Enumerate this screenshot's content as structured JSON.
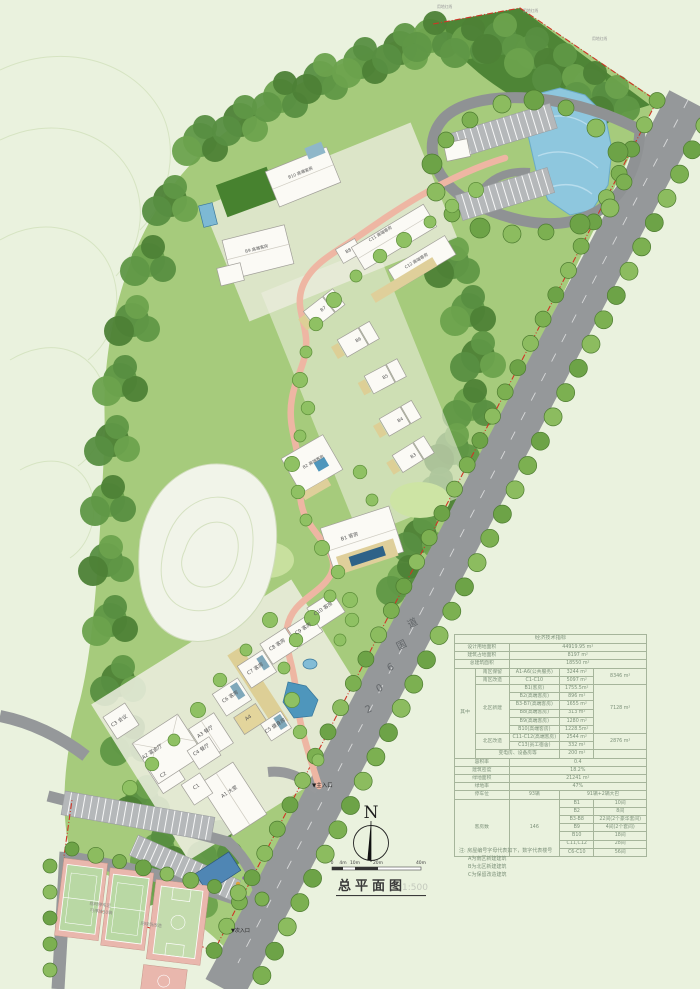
{
  "annot": {
    "north": "N",
    "title": "总平面图",
    "scale": "1:500",
    "bar": [
      "0",
      "4m",
      "10m",
      "20m",
      "40m"
    ]
  },
  "map": {
    "road": [
      "2",
      "0",
      "6",
      "国",
      "道"
    ],
    "entrance_main": "▼主入口",
    "entrance_secondary": "▼次入口",
    "boundary_label": "用地红线",
    "courts": {
      "parking_line1": "临时停车区",
      "parking_line2": "可停放50辆",
      "tennis_label": "网球场改造"
    },
    "buildings": {
      "a1": "A1 大堂",
      "a2": "A2 宴会厅",
      "a3": "A3 餐厅",
      "a4": "A4",
      "c1": "C1",
      "c2": "C2",
      "c3": "C3 会议",
      "c4": "C4 餐厅",
      "c5": "C5 健身房",
      "c6": "C6 客房",
      "c7": "C7 客房",
      "c8": "C8 客房",
      "c9": "C9 客房",
      "c10": "C10 客房",
      "b1": "B1 客房",
      "b2": "B2 高端客房",
      "b3": "B3",
      "b4": "B4",
      "b5": "B5",
      "b6": "B6",
      "b7": "B7",
      "b8": "B8",
      "b9": "B9 高端客房",
      "b10": "B10 高端客房",
      "c11": "C11 高端客房",
      "c12": "C12 高端客房"
    }
  },
  "ect": {
    "header": "经济技术指标",
    "r1l": "设计用地面积",
    "r1v": "44919.95 m²",
    "r2l": "建筑占地面积",
    "r2v": "8197  m²",
    "r3l": "总建筑面积",
    "r3v": "18550  m²",
    "among": "其中",
    "sk": "南区保留",
    "skn": "A1-A6(公共服务)",
    "skv": "3244 m²",
    "skt": "8346 m²",
    "sr": "南区改造",
    "srn": "C1-C10",
    "srv": "5097 m²",
    "nn": "北区新建",
    "nnt": "7128 m²",
    "nn1n": "B1(客房)",
    "nn1v": "1755.5m²",
    "nn2n": "B2(高端客房)",
    "nn2v": "896  m²",
    "nn3n": "B3-B7(高端客房)",
    "nn3v": "1655  m²",
    "nn4n": "B8(高端客房)",
    "nn4v": "313  m²",
    "nn5n": "B9(高端客房)",
    "nn5v": "1280  m²",
    "nn6n": "B10(高端客房)",
    "nn6v": "1228.5m²",
    "nr": "北区改造",
    "nrt": "2876 m²",
    "nr1n": "C11-C12(高端客房)",
    "nr1v": "2544 m²",
    "nr2n": "C13(员工宿舍)",
    "nr2v": "332  m²",
    "pw": "变电房、设备房等",
    "pwv": "200  m²",
    "far_l": "容积率",
    "far_v": "0.4",
    "den_l": "建筑密度",
    "den_v": "18.2%",
    "green_l": "绿地面积",
    "green_v": "21241    m²",
    "gr_l": "绿地率",
    "gr_v": "47%",
    "park_l": "停车位",
    "park_v": "93辆",
    "park_d": "91辆+2辆大巴",
    "room_l": "客房数",
    "room_v": "146",
    "rm1n": "B1",
    "rm1v": "10间",
    "rm2n": "B2",
    "rm2v": "8间",
    "rm3n": "B3-B8",
    "rm3v": "22间(2个豪华套间)",
    "rm4n": "B9",
    "rm4v": "4间(2个套间)",
    "rm5n": "B10",
    "rm5v": "18间",
    "rm6n": "C11,C12",
    "rm6v": "28间",
    "rm7n": "C6-C10",
    "rm7v": "56间",
    "note1": "注: 房屋编号字母代表如下，数字代表楼号",
    "note2": "A为南区新建建筑",
    "note3": "B为北区新建建筑",
    "note4": "C为保留改造建筑"
  }
}
